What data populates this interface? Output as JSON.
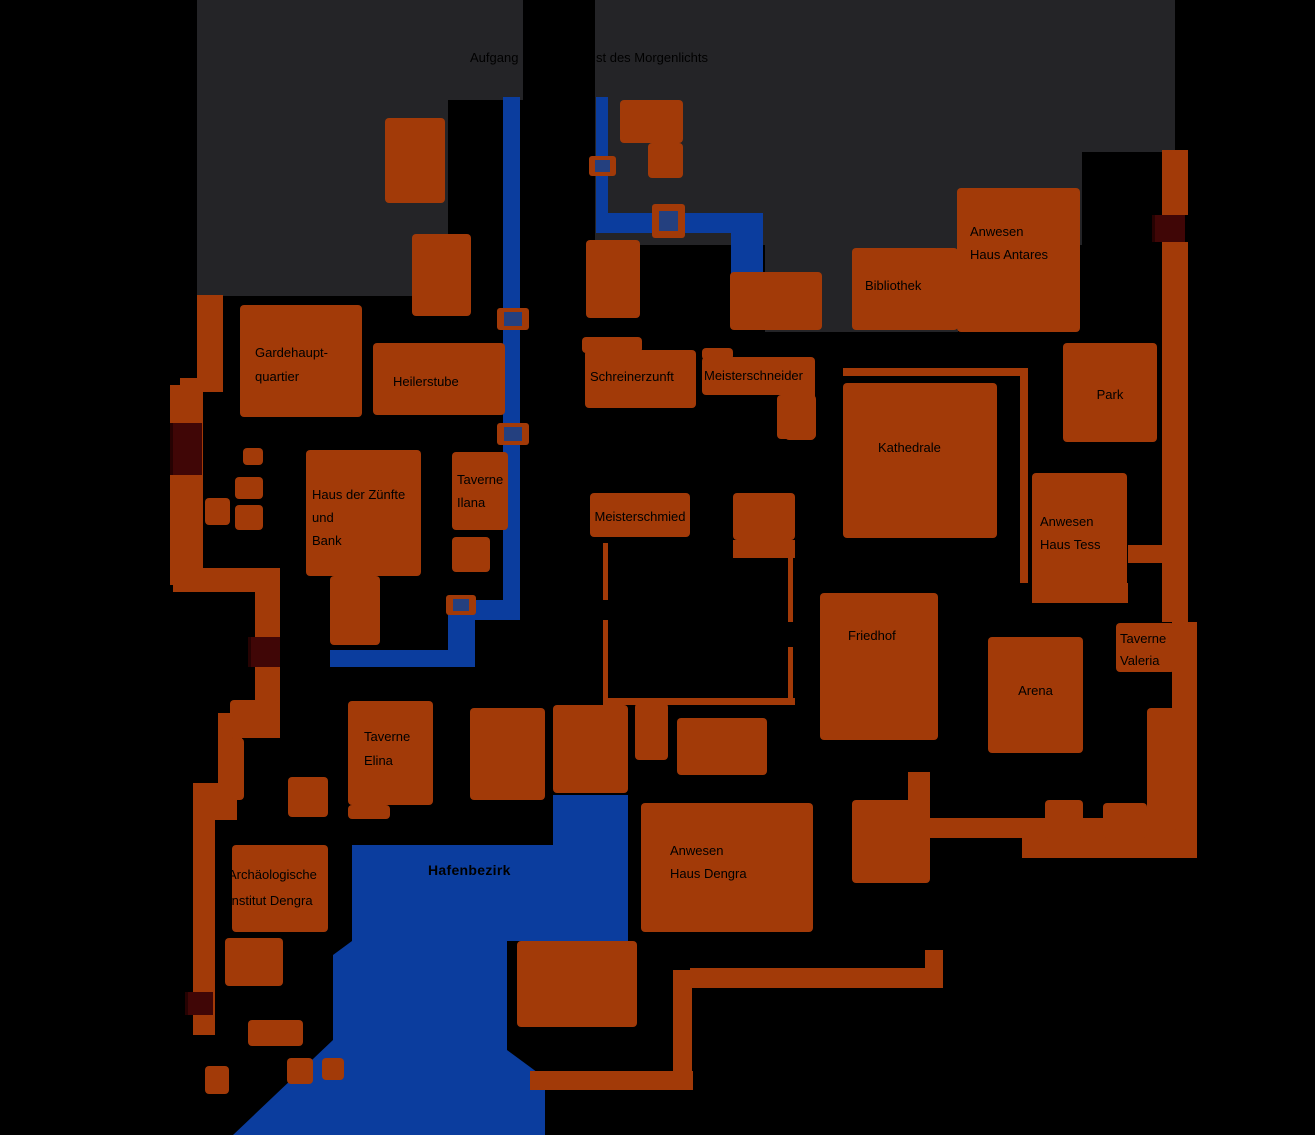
{
  "colors": {
    "background": "#000000",
    "district_zone": "#242427",
    "building": "#A23A08",
    "road": "#A23A08",
    "water": "#0B3D9E",
    "bridge_inner": "#24407F",
    "gate": "#400606",
    "label": "#000000"
  },
  "map": {
    "width": 1315,
    "height": 1135,
    "zones": [
      {
        "x": 197,
        "y": 0,
        "w": 326,
        "h": 100
      },
      {
        "x": 197,
        "y": 100,
        "w": 251,
        "h": 196
      },
      {
        "x": 595,
        "y": 0,
        "w": 580,
        "h": 152
      },
      {
        "x": 595,
        "y": 0,
        "w": 487,
        "h": 245
      },
      {
        "x": 765,
        "y": 0,
        "w": 193,
        "h": 332
      }
    ],
    "overlays": [
      {
        "x": 523,
        "y": 0,
        "w": 72,
        "h": 96
      }
    ],
    "water": {
      "rects": [
        {
          "x": 503,
          "y": 97,
          "w": 17,
          "h": 513
        },
        {
          "x": 448,
          "y": 600,
          "w": 72,
          "h": 20
        },
        {
          "x": 448,
          "y": 617,
          "w": 27,
          "h": 33
        },
        {
          "x": 330,
          "y": 650,
          "w": 145,
          "h": 17
        },
        {
          "x": 596,
          "y": 97,
          "w": 12,
          "h": 118
        },
        {
          "x": 596,
          "y": 213,
          "w": 167,
          "h": 20
        },
        {
          "x": 731,
          "y": 213,
          "w": 32,
          "h": 62
        }
      ],
      "harbor_polygon": "553,795 628,795 628,941 507,941 507,1050 545,1078 545,1135 233,1135 333,1040 333,955 352,941 352,845 553,845"
    },
    "bridges": [
      {
        "x": 497,
        "y": 308,
        "w": 32,
        "h": 22
      },
      {
        "x": 497,
        "y": 423,
        "w": 32,
        "h": 22
      },
      {
        "x": 446,
        "y": 595,
        "w": 30,
        "h": 20
      },
      {
        "x": 589,
        "y": 156,
        "w": 27,
        "h": 20
      },
      {
        "x": 652,
        "y": 204,
        "w": 33,
        "h": 34
      }
    ],
    "gates": [
      {
        "x": 170,
        "y": 423,
        "w": 32,
        "h": 52
      },
      {
        "x": 248,
        "y": 637,
        "w": 32,
        "h": 30
      },
      {
        "x": 185,
        "y": 992,
        "w": 28,
        "h": 23
      },
      {
        "x": 1152,
        "y": 215,
        "w": 33,
        "h": 27
      }
    ],
    "roads": [
      {
        "x": 197,
        "y": 295,
        "w": 26,
        "h": 90
      },
      {
        "x": 180,
        "y": 378,
        "w": 43,
        "h": 14
      },
      {
        "x": 170,
        "y": 385,
        "w": 33,
        "h": 200
      },
      {
        "x": 173,
        "y": 568,
        "w": 107,
        "h": 24
      },
      {
        "x": 255,
        "y": 568,
        "w": 25,
        "h": 170
      },
      {
        "x": 218,
        "y": 713,
        "w": 37,
        "h": 25
      },
      {
        "x": 218,
        "y": 713,
        "w": 24,
        "h": 78
      },
      {
        "x": 193,
        "y": 783,
        "w": 44,
        "h": 37
      },
      {
        "x": 193,
        "y": 783,
        "w": 22,
        "h": 252
      },
      {
        "x": 530,
        "y": 1071,
        "w": 163,
        "h": 19
      },
      {
        "x": 673,
        "y": 970,
        "w": 19,
        "h": 120
      },
      {
        "x": 690,
        "y": 968,
        "w": 253,
        "h": 20
      },
      {
        "x": 925,
        "y": 950,
        "w": 18,
        "h": 38
      },
      {
        "x": 908,
        "y": 772,
        "w": 22,
        "h": 48
      },
      {
        "x": 930,
        "y": 818,
        "w": 267,
        "h": 20
      },
      {
        "x": 1022,
        "y": 838,
        "w": 175,
        "h": 20
      },
      {
        "x": 1162,
        "y": 150,
        "w": 26,
        "h": 65
      },
      {
        "x": 1162,
        "y": 242,
        "w": 26,
        "h": 380
      },
      {
        "x": 1172,
        "y": 622,
        "w": 25,
        "h": 213
      },
      {
        "x": 1128,
        "y": 545,
        "w": 44,
        "h": 18
      },
      {
        "x": 1032,
        "y": 583,
        "w": 96,
        "h": 20
      }
    ],
    "walls": [
      {
        "x": 843,
        "y": 368,
        "w": 185,
        "h": 8
      },
      {
        "x": 1020,
        "y": 368,
        "w": 8,
        "h": 215
      },
      {
        "x": 603,
        "y": 543,
        "w": 5,
        "h": 57
      },
      {
        "x": 603,
        "y": 620,
        "w": 5,
        "h": 80
      },
      {
        "x": 603,
        "y": 698,
        "w": 192,
        "h": 7
      },
      {
        "x": 788,
        "y": 557,
        "w": 5,
        "h": 65
      },
      {
        "x": 788,
        "y": 647,
        "w": 5,
        "h": 51
      },
      {
        "x": 733,
        "y": 540,
        "w": 62,
        "h": 18
      }
    ],
    "buildings": [
      {
        "name": "gardehauptquartier",
        "x": 240,
        "y": 305,
        "w": 122,
        "h": 112,
        "lines": [
          "Gardehaupt-",
          "quartier"
        ],
        "dx": 15,
        "dy": 36,
        "lh": 24
      },
      {
        "name": "heilerstube",
        "x": 373,
        "y": 343,
        "w": 132,
        "h": 72,
        "lines": [
          "Heilerstube"
        ],
        "dx": 20,
        "dy": 27
      },
      {
        "name": "schreinerzunft",
        "x": 585,
        "y": 350,
        "w": 111,
        "h": 58,
        "lines": [
          "Schreinerzunft"
        ],
        "dx": 5,
        "dy": 15
      },
      {
        "name": "schreinerzunft-annex",
        "x": 582,
        "y": 337,
        "w": 60,
        "h": 16
      },
      {
        "name": "meisterschneider",
        "x": 702,
        "y": 357,
        "w": 113,
        "h": 38,
        "lines": [
          "Meisterschneider"
        ],
        "dx": 2,
        "dy": 7
      },
      {
        "name": "meisterschneider-annex",
        "x": 702,
        "y": 348,
        "w": 31,
        "h": 12
      },
      {
        "name": "meisterschneider-annex2",
        "x": 777,
        "y": 395,
        "w": 39,
        "h": 44
      },
      {
        "name": "bibliothek",
        "x": 852,
        "y": 248,
        "w": 106,
        "h": 82,
        "lines": [
          "Bibliothek"
        ],
        "dx": 13,
        "dy": 26
      },
      {
        "name": "anwesen-haus-antares",
        "x": 957,
        "y": 188,
        "w": 123,
        "h": 144,
        "lines": [
          "Anwesen",
          "Haus Antares"
        ],
        "dx": 13,
        "dy": 32,
        "lh": 23
      },
      {
        "name": "park",
        "x": 1063,
        "y": 343,
        "w": 94,
        "h": 99,
        "lines": [
          "Park"
        ],
        "center": true,
        "dy": 40
      },
      {
        "name": "kathedrale",
        "x": 843,
        "y": 383,
        "w": 154,
        "h": 155,
        "lines": [
          "Kathedrale"
        ],
        "dx": 35,
        "dy": 53
      },
      {
        "name": "anwesen-haus-tess",
        "x": 1032,
        "y": 473,
        "w": 95,
        "h": 130,
        "lines": [
          "Anwesen",
          "Haus Tess"
        ],
        "dx": 8,
        "dy": 37,
        "lh": 23
      },
      {
        "name": "friedhof",
        "x": 820,
        "y": 593,
        "w": 118,
        "h": 147,
        "lines": [
          "Friedhof"
        ],
        "dx": 28,
        "dy": 31
      },
      {
        "name": "taverne-valeria",
        "x": 1116,
        "y": 623,
        "w": 59,
        "h": 49,
        "lines": [
          "Taverne",
          "Valeria"
        ],
        "dx": 4,
        "dy": 5,
        "lh": 22
      },
      {
        "name": "arena",
        "x": 988,
        "y": 637,
        "w": 95,
        "h": 116,
        "lines": [
          "Arena"
        ],
        "center": true,
        "dy": 42
      },
      {
        "name": "haus-der-zuenfte-und-bank",
        "x": 306,
        "y": 450,
        "w": 115,
        "h": 126,
        "lines": [
          "Haus der Zünfte",
          "und",
          "Bank"
        ],
        "dx": 6,
        "dy": 33,
        "lh": 23
      },
      {
        "name": "haus-der-zuenfte-annex",
        "x": 330,
        "y": 576,
        "w": 50,
        "h": 69
      },
      {
        "name": "taverne-ilana",
        "x": 452,
        "y": 452,
        "w": 56,
        "h": 78,
        "lines": [
          "Taverne",
          "Ilana"
        ],
        "dx": 5,
        "dy": 16,
        "lh": 23
      },
      {
        "name": "taverne-ilana-annex",
        "x": 452,
        "y": 537,
        "w": 38,
        "h": 35
      },
      {
        "name": "meisterschmied",
        "x": 590,
        "y": 493,
        "w": 100,
        "h": 44,
        "lines": [
          "Meisterschmied"
        ],
        "center": true,
        "dy": 12
      },
      {
        "name": "taverne-elina",
        "x": 348,
        "y": 701,
        "w": 85,
        "h": 104,
        "lines": [
          "Taverne",
          "Elina"
        ],
        "dx": 16,
        "dy": 24,
        "lh": 24
      },
      {
        "name": "taverne-elina-annex",
        "x": 348,
        "y": 805,
        "w": 42,
        "h": 14
      },
      {
        "name": "anwesen-haus-dengra",
        "x": 641,
        "y": 803,
        "w": 172,
        "h": 129,
        "lines": [
          "Anwesen",
          "Haus Dengra"
        ],
        "dx": 29,
        "dy": 36,
        "lh": 23
      },
      {
        "name": "archaeologisches-institut-dengra",
        "x": 232,
        "y": 845,
        "w": 96,
        "h": 87,
        "lines": [
          "Archäologische",
          "Institut Dengra"
        ],
        "dx": -4,
        "dy": 17,
        "lh": 26,
        "clip": true
      },
      {
        "x": 385,
        "y": 118,
        "w": 60,
        "h": 85
      },
      {
        "x": 412,
        "y": 234,
        "w": 59,
        "h": 82
      },
      {
        "x": 620,
        "y": 100,
        "w": 63,
        "h": 43
      },
      {
        "x": 648,
        "y": 143,
        "w": 35,
        "h": 35
      },
      {
        "x": 586,
        "y": 240,
        "w": 54,
        "h": 78
      },
      {
        "x": 730,
        "y": 272,
        "w": 92,
        "h": 58
      },
      {
        "x": 785,
        "y": 388,
        "w": 30,
        "h": 52
      },
      {
        "x": 733,
        "y": 493,
        "w": 62,
        "h": 47
      },
      {
        "x": 635,
        "y": 703,
        "w": 33,
        "h": 57
      },
      {
        "x": 677,
        "y": 718,
        "w": 90,
        "h": 57
      },
      {
        "x": 470,
        "y": 708,
        "w": 75,
        "h": 92
      },
      {
        "x": 553,
        "y": 705,
        "w": 75,
        "h": 88
      },
      {
        "x": 852,
        "y": 800,
        "w": 78,
        "h": 83
      },
      {
        "x": 517,
        "y": 941,
        "w": 120,
        "h": 86
      },
      {
        "x": 1147,
        "y": 708,
        "w": 31,
        "h": 122
      },
      {
        "x": 1045,
        "y": 800,
        "w": 38,
        "h": 38
      },
      {
        "x": 1103,
        "y": 803,
        "w": 44,
        "h": 35
      },
      {
        "x": 225,
        "y": 938,
        "w": 58,
        "h": 48
      },
      {
        "x": 248,
        "y": 1020,
        "w": 55,
        "h": 26
      },
      {
        "x": 287,
        "y": 1058,
        "w": 26,
        "h": 26
      },
      {
        "x": 322,
        "y": 1058,
        "w": 22,
        "h": 22
      },
      {
        "x": 205,
        "y": 1066,
        "w": 24,
        "h": 28
      },
      {
        "x": 288,
        "y": 777,
        "w": 40,
        "h": 40
      },
      {
        "x": 230,
        "y": 700,
        "w": 48,
        "h": 38
      },
      {
        "x": 230,
        "y": 738,
        "w": 14,
        "h": 62
      },
      {
        "x": 243,
        "y": 448,
        "w": 20,
        "h": 17
      },
      {
        "x": 235,
        "y": 477,
        "w": 28,
        "h": 22
      },
      {
        "x": 205,
        "y": 498,
        "w": 25,
        "h": 27
      },
      {
        "x": 235,
        "y": 505,
        "w": 28,
        "h": 25
      }
    ],
    "labels": [
      {
        "name": "aufgang-label-left",
        "text": "Aufgang",
        "x": 470,
        "y": 50
      },
      {
        "name": "aufgang-label-right",
        "text": "st des Morgenlichts",
        "x": 596,
        "y": 50
      },
      {
        "name": "hafenbezirk-label",
        "text": "Hafenbezirk",
        "x": 428,
        "y": 862,
        "bold": true
      }
    ]
  }
}
